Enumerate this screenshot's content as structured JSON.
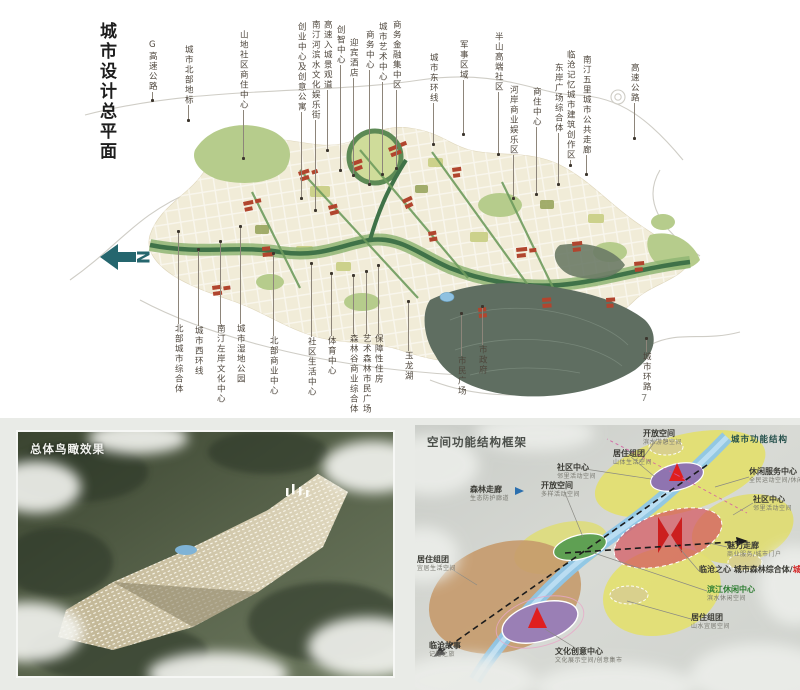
{
  "page": {
    "page_number": "7"
  },
  "master_plan": {
    "title": "城市设计总平面",
    "north_label": "N",
    "labels_top": [
      "G高速公路",
      "城市北部地标",
      "山地社区商住中心",
      "创业中心及创意公寓",
      "南汀河滨水文化娱乐街",
      "高速入城景观道",
      "创智中心",
      "迎宾酒店",
      "商务中心",
      "城市艺术中心",
      "商务金融集中区",
      "城市东环线",
      "军事区域",
      "半山高端社区",
      "河岸商业娱乐区",
      "商住中心",
      "东岸广场综合体",
      "临沧记忆城市建筑创作区",
      "南汀五里城市公共走廊",
      "高速公路"
    ],
    "labels_bottom": [
      "北部城市综合体",
      "城市西环线",
      "南汀左岸文化中心",
      "城市湿地公园",
      "北部商业中心",
      "社区生活中心",
      "体育中心",
      "森林谷商业综合体",
      "艺术森林市民广场",
      "保障性住房",
      "玉龙湖",
      "市民广场",
      "市政府",
      "城市环路"
    ]
  },
  "aerial_view": {
    "title": "总体鸟瞰效果"
  },
  "structure_diagram": {
    "title": "空间功能结构框架",
    "corner_title": "城市功能结构",
    "labels": [
      {
        "text": "森林走廊",
        "sub": "生态防护廊道"
      },
      {
        "text": "开放空间",
        "sub": "多样活动空间"
      },
      {
        "text": "居住组团",
        "sub": "宜居生活空间"
      },
      {
        "text": "临沧故事",
        "sub": "记忆之旅"
      },
      {
        "text": "文化创意中心",
        "sub": "文化展示空间/创意集市"
      },
      {
        "text": "开放空间",
        "sub": "滨水游憩空间"
      },
      {
        "text": "居住组团",
        "sub": "山体生活空间"
      },
      {
        "text": "社区中心",
        "sub": "邻里活动空间"
      },
      {
        "text": "休闲服务中心",
        "sub": "全民运动空间/休闲服务"
      },
      {
        "text": "社区中心",
        "sub": "邻里活动空间"
      },
      {
        "text": "魅力走廊",
        "sub": "商业服务/城市门户"
      },
      {
        "text": "临沧之心 城市森林综合体/",
        "accent": "城市地标",
        "sub": ""
      },
      {
        "text": "滨江休闲中心",
        "sub": "滨水休闲空间",
        "color": "green"
      },
      {
        "text": "居住组团",
        "sub": "山水宜居空间"
      }
    ]
  },
  "colors": {
    "north_arrow": "#25666e",
    "map_red": "#b1452e",
    "map_green_corridor": "#3f7248",
    "map_forest": "#5f6e61",
    "diagram_yellow": "#e3e06e",
    "diagram_purple": "#8f74b0",
    "diagram_tan": "#c59a6b",
    "diagram_landmark_red": "#cc1f1f",
    "river_blue": "#8ec6e8"
  }
}
